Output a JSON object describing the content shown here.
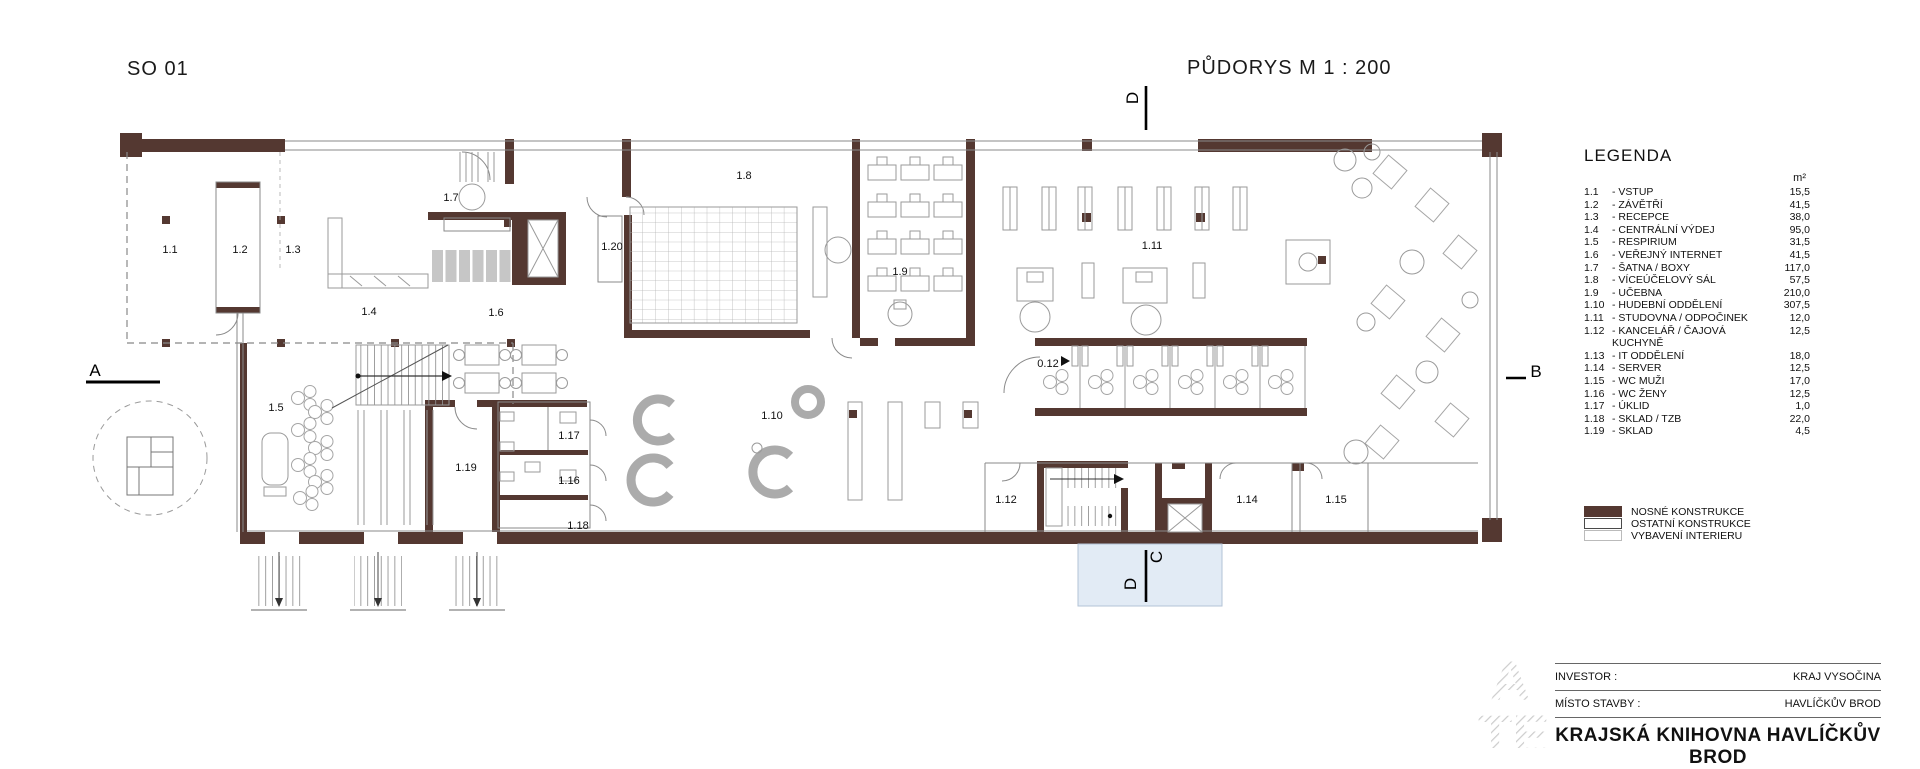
{
  "drawing": {
    "structure_label": "SO 01",
    "plan_title": "PŮDORYS M 1 : 200",
    "markers": {
      "left": "A",
      "right": "B",
      "top": "D",
      "bottom_c": "C",
      "bottom_d": "D"
    },
    "room_labels": [
      "1.1",
      "1.2",
      "1.3",
      "1.7",
      "1.20",
      "1.8",
      "1.4",
      "1.6",
      "1.9",
      "1.11",
      "1.5",
      "1.19",
      "1.17",
      "1.16",
      "1.18",
      "1.10",
      "0.12",
      "1.12",
      "1.14",
      "1.15"
    ]
  },
  "legend": {
    "title": "LEGENDA",
    "unit": "m²",
    "separator": "-",
    "items": [
      {
        "id": "1.1",
        "name": "VSTUP",
        "area": "15,5"
      },
      {
        "id": "1.2",
        "name": "ZÁVĚTŘÍ",
        "area": "41,5"
      },
      {
        "id": "1.3",
        "name": "RECEPCE",
        "area": "38,0"
      },
      {
        "id": "1.4",
        "name": "CENTRÁLNÍ VÝDEJ",
        "area": "95,0"
      },
      {
        "id": "1.5",
        "name": "RESPIRIUM",
        "area": "31,5"
      },
      {
        "id": "1.6",
        "name": "VEŘEJNÝ INTERNET",
        "area": "41,5"
      },
      {
        "id": "1.7",
        "name": "ŠATNA / BOXY",
        "area": "117,0"
      },
      {
        "id": "1.8",
        "name": "VÍCEÚČELOVÝ SÁL",
        "area": "57,5"
      },
      {
        "id": "1.9",
        "name": "UČEBNA",
        "area": "210,0"
      },
      {
        "id": "1.10",
        "name": "HUDEBNÍ ODDĚLENÍ",
        "area": "307,5"
      },
      {
        "id": "1.11",
        "name": "STUDOVNA / ODPOČINEK",
        "area": "12,0"
      },
      {
        "id": "1.12",
        "name": "KANCELÁŘ / ČAJOVÁ KUCHYNĚ",
        "area": "12,5"
      },
      {
        "id": "1.13",
        "name": "IT ODDĚLENÍ",
        "area": "18,0"
      },
      {
        "id": "1.14",
        "name": "SERVER",
        "area": "12,5"
      },
      {
        "id": "1.15",
        "name": "WC MUŽI",
        "area": "17,0"
      },
      {
        "id": "1.16",
        "name": "WC ŽENY",
        "area": "12,5"
      },
      {
        "id": "1.17",
        "name": "ÚKLID",
        "area": "1,0"
      },
      {
        "id": "1.18",
        "name": "SKLAD / TZB",
        "area": "22,0"
      },
      {
        "id": "1.19",
        "name": "SKLAD",
        "area": "4,5"
      }
    ],
    "construction": [
      {
        "label": "NOSNÉ KONSTRUKCE",
        "swatch": "solid"
      },
      {
        "label": "OSTATNÍ KONSTRUKCE",
        "swatch": "outline-dark"
      },
      {
        "label": "VYBAVENÍ INTERIERU",
        "swatch": "outline-light"
      }
    ]
  },
  "title_block": {
    "investor_label": "INVESTOR :",
    "investor_value": "KRAJ VYSOČINA",
    "site_label": "MÍSTO STAVBY :",
    "site_value": "HAVLÍČKŮV BROD",
    "project_title": "KRAJSKÁ KNIHOVNA  HAVLÍČKŮV BROD",
    "logo_top": "A",
    "logo_bottom": "TE"
  },
  "colors": {
    "wall": "#543831",
    "section_fill": "#e2ebf5",
    "furniture_line": "#9a9a9a"
  }
}
